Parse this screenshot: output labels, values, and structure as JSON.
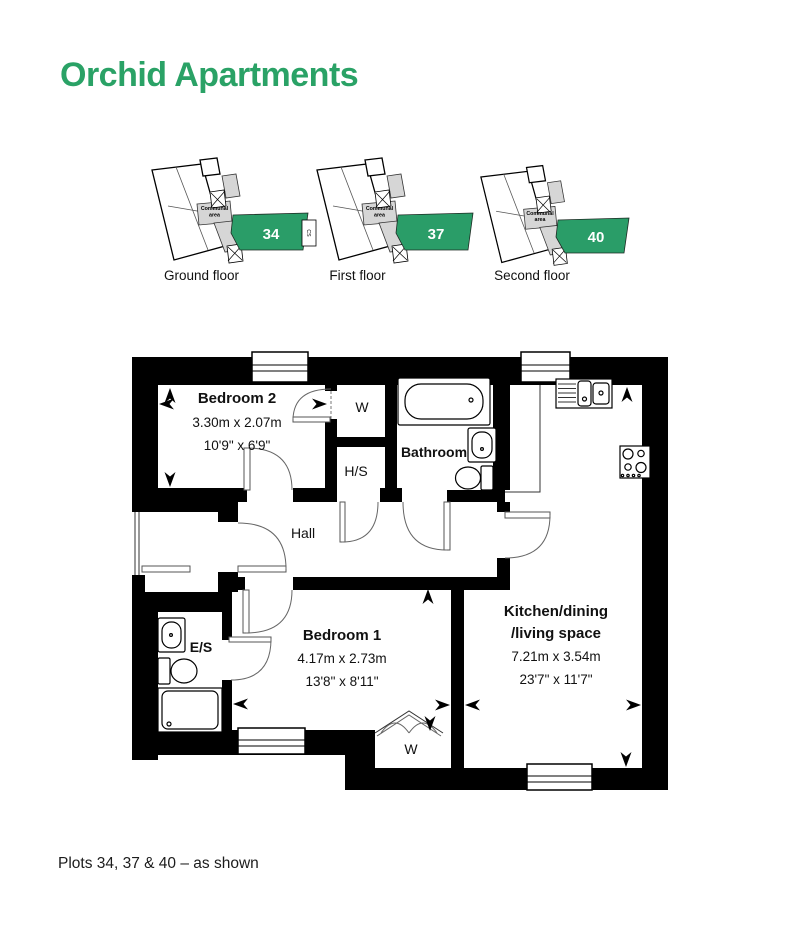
{
  "title": "Orchid Apartments",
  "caption": "Plots 34, 37 & 40 – as shown",
  "colors": {
    "accent_green": "#2aa266",
    "plot_green": "#2a9d68",
    "communal_gray": "#d6d6d6",
    "wall_black": "#000000"
  },
  "locators": [
    {
      "floor_label": "Ground floor",
      "plot_number": "34",
      "communal_line1": "Communal",
      "communal_line2": "area",
      "cs_label": "CS"
    },
    {
      "floor_label": "First floor",
      "plot_number": "37",
      "communal_line1": "Communal",
      "communal_line2": "area"
    },
    {
      "floor_label": "Second floor",
      "plot_number": "40",
      "communal_line1": "Communal",
      "communal_line2": "area"
    }
  ],
  "rooms": {
    "bedroom2": {
      "name": "Bedroom 2",
      "metric": "3.30m x 2.07m",
      "imperial": "10'9\" x 6'9\""
    },
    "bedroom1": {
      "name": "Bedroom 1",
      "metric": "4.17m x 2.73m",
      "imperial": "13'8\" x 8'11\""
    },
    "kitchen": {
      "line1": "Kitchen/dining",
      "line2": "/living space",
      "metric": "7.21m x 3.54m",
      "imperial": "23'7\" x 11'7\""
    },
    "bathroom": {
      "name": "Bathroom"
    },
    "hall": {
      "label": "Hall"
    },
    "wardrobe_top": {
      "label": "W"
    },
    "wardrobe_bottom": {
      "label": "W"
    },
    "hs": {
      "label": "H/S"
    },
    "ensuite": {
      "label": "E/S"
    }
  }
}
